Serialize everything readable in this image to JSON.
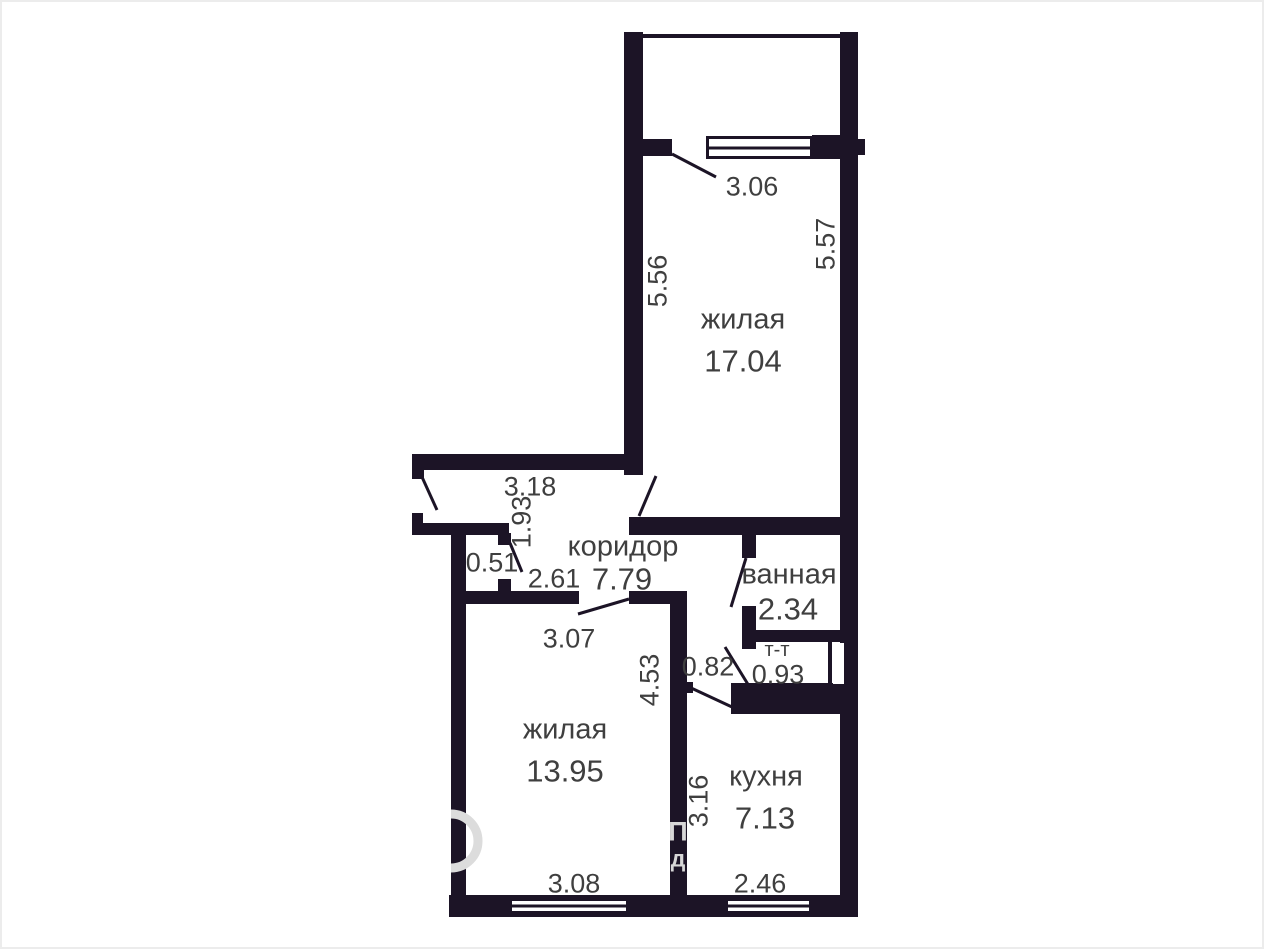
{
  "colors": {
    "wall": "#1c1426",
    "text": "#3f3f3f",
    "watermark": "#d7d7d7",
    "background": "#ffffff"
  },
  "rooms": {
    "living_top": {
      "name": "жилая",
      "area": "17.04"
    },
    "corridor": {
      "name": "коридор",
      "area": "7.79"
    },
    "bathroom": {
      "name": "ванная",
      "area": "2.34"
    },
    "toilet": {
      "name": "т-т",
      "area": "0.93"
    },
    "living_bottom": {
      "name": "жилая",
      "area": "13.95"
    },
    "kitchen": {
      "name": "кухня",
      "area": "7.13"
    }
  },
  "dimensions": {
    "top_window": "3.06",
    "living_top_left": "5.56",
    "living_top_right": "5.57",
    "entry_width": "3.18",
    "entry_depth": "1.93",
    "closet": "0.51",
    "hall_width": "2.61",
    "living_bottom_door": "3.07",
    "passage": "0.82",
    "living_bottom_height": "4.53",
    "kitchen_height": "3.16",
    "living_bottom_width": "3.08",
    "kitchen_width": "2.46"
  },
  "watermark": {
    "letter_1": "П",
    "letter_2": "д"
  }
}
